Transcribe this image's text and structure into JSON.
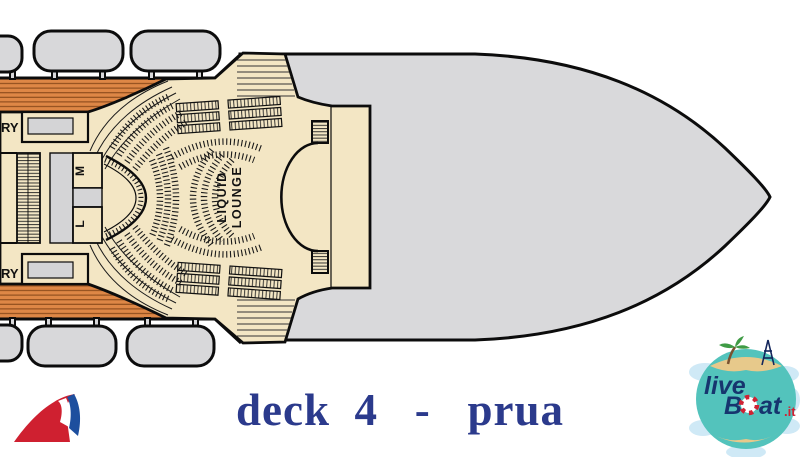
{
  "plan": {
    "labels": {
      "ry_top": "RY",
      "ry_bottom": "RY",
      "room_m": "M",
      "room_l": "L"
    },
    "venue": {
      "name_line1": "LIQUID",
      "name_line2": "LOUNGE"
    }
  },
  "footer": {
    "deck_title": "deck  4   -   prua"
  },
  "logos": {
    "liveboat": {
      "part1": "live",
      "part2": "B",
      "part3": "at",
      "part4": ".it"
    },
    "carnival": {
      "icon": "carnival-funnel-icon"
    }
  },
  "colors": {
    "hull_gray": "#d9d9db",
    "deck_wood": "#de8746",
    "floor_beige": "#f3e6c4",
    "title_blue": "#2b3a8c",
    "carnival_red": "#cf2030",
    "carnival_blue": "#1d4f9e",
    "globe_teal": "#53c3bc"
  }
}
